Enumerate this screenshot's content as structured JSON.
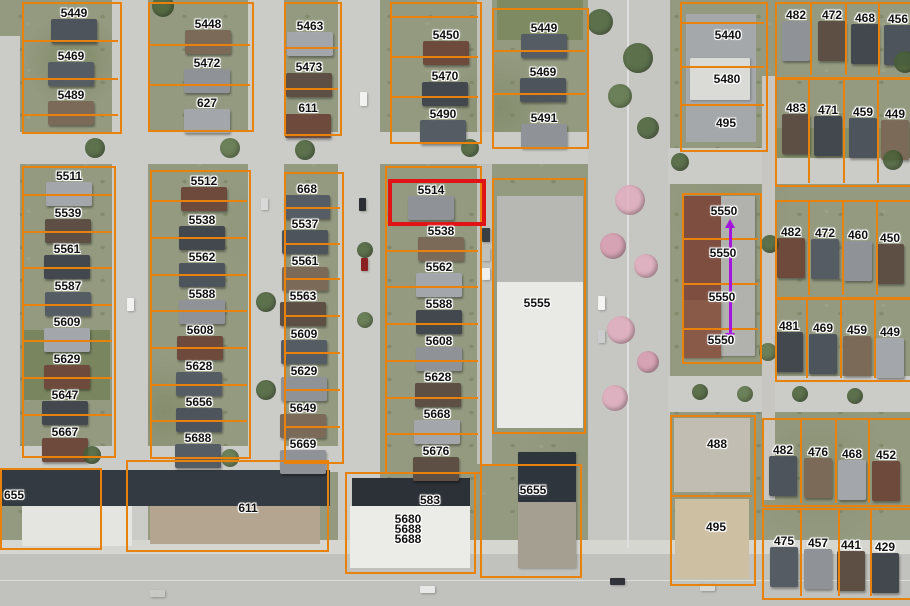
{
  "colors": {
    "parcel_line": "#e8820c",
    "highlight_red": "#e01414",
    "arrow_purple": "#a414dc",
    "label_text": "#111111",
    "label_halo": "#ffffff",
    "road": "#cbcbc7",
    "roof_palette": [
      "#4e545c",
      "#7b6a58",
      "#a3a7ab",
      "#6e4a3c",
      "#565c63",
      "#8f9397",
      "#5d4f44",
      "#43484f"
    ]
  },
  "highlight": {
    "label": "5514",
    "x": 388,
    "y": 179,
    "w": 90,
    "h": 39,
    "border": 4
  },
  "measurement_arrow": {
    "x": 730,
    "y_start": 228,
    "y_end": 333
  },
  "map": {
    "roads": [
      [
        0,
        36,
        20,
        430,
        "#cbcbc7"
      ],
      [
        112,
        0,
        36,
        554,
        "#cbcbc7"
      ],
      [
        248,
        0,
        36,
        474,
        "#cbcbc7"
      ],
      [
        338,
        0,
        42,
        554,
        "#cbcbc7"
      ],
      [
        477,
        0,
        15,
        464,
        "#c1c1bc"
      ],
      [
        588,
        0,
        82,
        560,
        "#c6c6c2"
      ],
      [
        0,
        132,
        588,
        32,
        "#cbcbc7"
      ],
      [
        668,
        148,
        242,
        36,
        "#cbcbc7"
      ],
      [
        668,
        376,
        242,
        36,
        "#cbcbc7"
      ],
      [
        0,
        446,
        345,
        26,
        "#cbcbc7"
      ],
      [
        762,
        76,
        13,
        424,
        "#c7c6c1"
      ],
      [
        0,
        540,
        910,
        14,
        "#d6d6d1"
      ],
      [
        0,
        554,
        910,
        52,
        "#c1c1bd"
      ],
      [
        627,
        0,
        2,
        548,
        "#dedede"
      ],
      [
        0,
        580,
        910,
        1,
        "#dcdcd8"
      ]
    ],
    "buildings": [
      [
        497,
        0,
        86,
        40,
        "#7d8a62"
      ],
      [
        775,
        128,
        135,
        30,
        "#87906c"
      ],
      [
        24,
        330,
        86,
        70,
        "#79855f"
      ],
      [
        686,
        14,
        70,
        128,
        "#a4a8aa"
      ],
      [
        690,
        58,
        60,
        42,
        "#dadad6"
      ],
      [
        497,
        196,
        86,
        86,
        "#b7b7b3"
      ],
      [
        497,
        282,
        86,
        146,
        "#e9e9e6"
      ],
      [
        683,
        196,
        38,
        160,
        "#7e4f41"
      ],
      [
        721,
        196,
        34,
        160,
        "#b1b1ad"
      ],
      [
        683,
        300,
        38,
        58,
        "#8a5a49"
      ],
      [
        674,
        418,
        76,
        74,
        "#c2bdb2"
      ],
      [
        675,
        499,
        74,
        80,
        "#cdbfa2"
      ],
      [
        0,
        470,
        330,
        36,
        "#343a41"
      ],
      [
        22,
        506,
        110,
        40,
        "#e4e4e1"
      ],
      [
        150,
        506,
        170,
        38,
        "#b3a58f"
      ],
      [
        352,
        478,
        118,
        30,
        "#2c3137"
      ],
      [
        350,
        506,
        120,
        62,
        "#ebebe8"
      ],
      [
        518,
        452,
        58,
        50,
        "#2f353c"
      ],
      [
        518,
        502,
        58,
        66,
        "#a59f91"
      ],
      [
        360,
        92,
        7,
        14,
        "#f2f2f0"
      ],
      [
        359,
        198,
        7,
        13,
        "#2b2f33"
      ],
      [
        361,
        258,
        7,
        13,
        "#8b2020"
      ],
      [
        127,
        298,
        7,
        13,
        "#f2f2f0"
      ],
      [
        261,
        198,
        7,
        12,
        "#d8d8d8"
      ],
      [
        482,
        228,
        8,
        14,
        "#3a3f44"
      ],
      [
        482,
        248,
        8,
        13,
        "#c0c0bc"
      ],
      [
        482,
        268,
        8,
        12,
        "#f0f0ee"
      ],
      [
        598,
        296,
        7,
        14,
        "#f4f4f2"
      ],
      [
        598,
        330,
        7,
        13,
        "#caccce"
      ],
      [
        420,
        586,
        15,
        7,
        "#e8e8e8"
      ],
      [
        610,
        578,
        15,
        7,
        "#30343a"
      ],
      [
        150,
        590,
        15,
        7,
        "#c8c8c4"
      ],
      [
        700,
        584,
        15,
        7,
        "#d8d8d4"
      ]
    ],
    "trees": [
      [
        600,
        22,
        13,
        "#4a6238"
      ],
      [
        638,
        58,
        15,
        "#4a6238"
      ],
      [
        620,
        96,
        12,
        "#5c7446"
      ],
      [
        648,
        128,
        11,
        "#4a6238"
      ],
      [
        630,
        200,
        15,
        "#e3aec0"
      ],
      [
        613,
        246,
        13,
        "#d99db2"
      ],
      [
        646,
        266,
        12,
        "#e3aec0"
      ],
      [
        621,
        330,
        14,
        "#e3aec0"
      ],
      [
        648,
        362,
        11,
        "#d99db2"
      ],
      [
        615,
        398,
        13,
        "#e3aec0"
      ],
      [
        163,
        6,
        11,
        "#4a6238"
      ],
      [
        95,
        148,
        10,
        "#4a6238"
      ],
      [
        230,
        148,
        10,
        "#5c7446"
      ],
      [
        305,
        150,
        10,
        "#4a6238"
      ],
      [
        470,
        148,
        9,
        "#4a6238"
      ],
      [
        365,
        250,
        8,
        "#4a6238"
      ],
      [
        365,
        320,
        8,
        "#5c7446"
      ],
      [
        266,
        302,
        10,
        "#4a6238"
      ],
      [
        266,
        390,
        10,
        "#4a6238"
      ],
      [
        92,
        455,
        9,
        "#4a6238"
      ],
      [
        230,
        458,
        9,
        "#5c7446"
      ],
      [
        680,
        162,
        9,
        "#4a6238"
      ],
      [
        770,
        244,
        9,
        "#4a6238"
      ],
      [
        768,
        352,
        9,
        "#5c7446"
      ],
      [
        905,
        62,
        11,
        "#4a6238"
      ],
      [
        893,
        160,
        10,
        "#4a6238"
      ],
      [
        700,
        392,
        8,
        "#4a6238"
      ],
      [
        745,
        394,
        8,
        "#5c7446"
      ],
      [
        800,
        394,
        8,
        "#4a6238"
      ],
      [
        855,
        396,
        8,
        "#4a6238"
      ]
    ],
    "blocks": [
      {
        "x": 22,
        "y": 2,
        "w": 96,
        "h": 128,
        "hd": [
          40,
          78,
          114
        ]
      },
      {
        "x": 148,
        "y": 2,
        "w": 102,
        "h": 126,
        "hd": [
          44,
          84
        ]
      },
      {
        "x": 284,
        "y": 2,
        "w": 54,
        "h": 130,
        "hd": [
          47,
          88
        ]
      },
      {
        "x": 390,
        "y": 2,
        "w": 88,
        "h": 138,
        "hd": [
          16,
          56,
          96
        ]
      },
      {
        "x": 492,
        "y": 8,
        "w": 93,
        "h": 137,
        "hd": [
          50,
          93
        ]
      },
      {
        "x": 680,
        "y": 2,
        "w": 84,
        "h": 146,
        "hd": [
          22,
          66,
          104
        ]
      },
      {
        "x": 775,
        "y": 2,
        "w": 135,
        "h": 73,
        "vd": [
          810,
          845,
          878
        ]
      },
      {
        "x": 775,
        "y": 78,
        "w": 135,
        "h": 105,
        "vd": [
          808,
          843,
          877
        ]
      },
      {
        "x": 22,
        "y": 166,
        "w": 90,
        "h": 288,
        "hd": [
          194,
          231,
          267,
          304,
          340,
          377,
          414
        ]
      },
      {
        "x": 150,
        "y": 170,
        "w": 97,
        "h": 285,
        "hd": [
          200,
          237,
          274,
          310,
          347,
          384,
          420
        ]
      },
      {
        "x": 284,
        "y": 172,
        "w": 56,
        "h": 288,
        "hd": [
          207,
          243,
          278,
          315,
          352,
          389,
          426
        ]
      },
      {
        "x": 385,
        "y": 166,
        "w": 93,
        "h": 304,
        "hd": [
          222,
          250,
          286,
          323,
          360,
          397,
          433
        ]
      },
      {
        "x": 492,
        "y": 178,
        "w": 90,
        "h": 252
      },
      {
        "x": 682,
        "y": 193,
        "w": 76,
        "h": 167,
        "hd": [
          238,
          283,
          328
        ]
      },
      {
        "x": 775,
        "y": 200,
        "w": 135,
        "h": 95,
        "vd": [
          808,
          842,
          876
        ]
      },
      {
        "x": 775,
        "y": 298,
        "w": 135,
        "h": 80,
        "vd": [
          806,
          840,
          874
        ]
      },
      {
        "x": 670,
        "y": 415,
        "w": 82,
        "h": 167,
        "hd": [
          495
        ]
      },
      {
        "x": 762,
        "y": 418,
        "w": 148,
        "h": 85,
        "vd": [
          800,
          835,
          868
        ]
      },
      {
        "x": 762,
        "y": 508,
        "w": 148,
        "h": 88,
        "vd": [
          800,
          838,
          870
        ]
      },
      {
        "x": 0,
        "y": 468,
        "w": 98,
        "h": 78
      },
      {
        "x": 126,
        "y": 460,
        "w": 199,
        "h": 88
      },
      {
        "x": 345,
        "y": 472,
        "w": 127,
        "h": 98
      },
      {
        "x": 480,
        "y": 464,
        "w": 98,
        "h": 110
      }
    ],
    "labels": [
      [
        "5449",
        74,
        13,
        1
      ],
      [
        "5448",
        208,
        24,
        1
      ],
      [
        "5463",
        310,
        26,
        1
      ],
      [
        "5450",
        446,
        35,
        1
      ],
      [
        "5449",
        544,
        28,
        1
      ],
      [
        "482",
        796,
        15,
        1
      ],
      [
        "472",
        832,
        15,
        1
      ],
      [
        "468",
        865,
        18,
        1
      ],
      [
        "456",
        898,
        19,
        1
      ],
      [
        "5440",
        728,
        35,
        0
      ],
      [
        "5480",
        727,
        79,
        0
      ],
      [
        "495",
        726,
        123,
        0
      ],
      [
        "5469",
        71,
        56,
        1
      ],
      [
        "5472",
        207,
        63,
        1
      ],
      [
        "5473",
        309,
        67,
        1
      ],
      [
        "5470",
        445,
        76,
        1
      ],
      [
        "5469",
        543,
        72,
        1
      ],
      [
        "5489",
        71,
        95,
        1
      ],
      [
        "627",
        207,
        103,
        1
      ],
      [
        "611",
        308,
        108,
        1
      ],
      [
        "5490",
        443,
        114,
        1
      ],
      [
        "5491",
        544,
        118,
        1
      ],
      [
        "483",
        796,
        108,
        1
      ],
      [
        "471",
        828,
        110,
        1
      ],
      [
        "459",
        863,
        112,
        1
      ],
      [
        "449",
        895,
        114,
        1
      ],
      [
        "5511",
        69,
        176,
        1
      ],
      [
        "5512",
        204,
        181,
        1
      ],
      [
        "668",
        307,
        189,
        1
      ],
      [
        "5514",
        431,
        190,
        1
      ],
      [
        "5539",
        68,
        213,
        1
      ],
      [
        "5538",
        202,
        220,
        1
      ],
      [
        "5537",
        305,
        224,
        1
      ],
      [
        "5538",
        441,
        231,
        1
      ],
      [
        "5550",
        724,
        211,
        0
      ],
      [
        "482",
        791,
        232,
        1
      ],
      [
        "472",
        825,
        233,
        1
      ],
      [
        "460",
        858,
        235,
        1
      ],
      [
        "450",
        890,
        238,
        1
      ],
      [
        "5561",
        67,
        249,
        1
      ],
      [
        "5562",
        202,
        257,
        1
      ],
      [
        "5561",
        305,
        261,
        1
      ],
      [
        "5562",
        439,
        267,
        1
      ],
      [
        "5550",
        723,
        253,
        0
      ],
      [
        "5587",
        68,
        286,
        1
      ],
      [
        "5588",
        202,
        294,
        1
      ],
      [
        "5563",
        303,
        296,
        1
      ],
      [
        "5588",
        439,
        304,
        1
      ],
      [
        "5555",
        537,
        303,
        0
      ],
      [
        "5550",
        722,
        297,
        0
      ],
      [
        "5609",
        67,
        322,
        1
      ],
      [
        "5608",
        200,
        330,
        1
      ],
      [
        "5609",
        304,
        334,
        1
      ],
      [
        "5608",
        439,
        341,
        1
      ],
      [
        "5550",
        721,
        340,
        0
      ],
      [
        "481",
        789,
        326,
        1
      ],
      [
        "469",
        823,
        328,
        1
      ],
      [
        "459",
        857,
        330,
        1
      ],
      [
        "449",
        890,
        332,
        1
      ],
      [
        "5629",
        67,
        359,
        1
      ],
      [
        "5628",
        199,
        366,
        1
      ],
      [
        "5629",
        304,
        371,
        1
      ],
      [
        "5628",
        438,
        377,
        1
      ],
      [
        "5647",
        65,
        395,
        1
      ],
      [
        "5656",
        199,
        402,
        1
      ],
      [
        "5649",
        303,
        408,
        1
      ],
      [
        "5668",
        437,
        414,
        1
      ],
      [
        "5667",
        65,
        432,
        1
      ],
      [
        "5688",
        198,
        438,
        1
      ],
      [
        "5669",
        303,
        444,
        1
      ],
      [
        "5676",
        436,
        451,
        1
      ],
      [
        "488",
        717,
        444,
        0
      ],
      [
        "482",
        783,
        450,
        1
      ],
      [
        "476",
        818,
        452,
        1
      ],
      [
        "468",
        852,
        454,
        1
      ],
      [
        "452",
        886,
        455,
        1
      ],
      [
        "655",
        14,
        495,
        0
      ],
      [
        "611",
        248,
        508,
        0
      ],
      [
        "583",
        430,
        500,
        0
      ],
      [
        "5680",
        408,
        519,
        0
      ],
      [
        "5688",
        408,
        529,
        0
      ],
      [
        "5688",
        408,
        539,
        0
      ],
      [
        "5655",
        533,
        490,
        0
      ],
      [
        "495",
        716,
        527,
        0
      ],
      [
        "475",
        784,
        541,
        1
      ],
      [
        "457",
        818,
        543,
        1
      ],
      [
        "441",
        851,
        545,
        1
      ],
      [
        "429",
        885,
        547,
        1
      ]
    ]
  }
}
